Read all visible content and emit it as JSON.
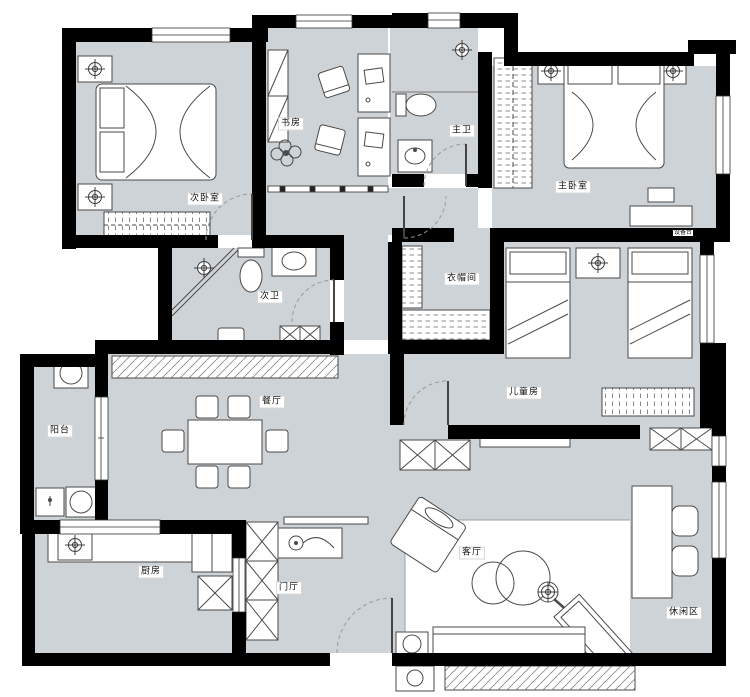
{
  "floorplan": {
    "title": "apartment-floor-plan",
    "rooms": [
      {
        "id": "bedroom2",
        "label": "次卧室"
      },
      {
        "id": "study",
        "label": "书房"
      },
      {
        "id": "master-bath",
        "label": "主卫"
      },
      {
        "id": "master-bedroom",
        "label": "主卧室"
      },
      {
        "id": "equipment-platform",
        "label": "设备台"
      },
      {
        "id": "bath2",
        "label": "次卫"
      },
      {
        "id": "cloakroom",
        "label": "衣帽间"
      },
      {
        "id": "kids-room",
        "label": "儿童房"
      },
      {
        "id": "dining-room",
        "label": "餐厅"
      },
      {
        "id": "balcony",
        "label": "阳台"
      },
      {
        "id": "kitchen",
        "label": "厨房"
      },
      {
        "id": "foyer",
        "label": "门厅"
      },
      {
        "id": "living-room",
        "label": "客厅"
      },
      {
        "id": "leisure-area",
        "label": "休闲区"
      }
    ],
    "colors": {
      "wall": "#000000",
      "floor": "#cdd3d6",
      "furniture_outline": "#4a4a4a"
    }
  }
}
